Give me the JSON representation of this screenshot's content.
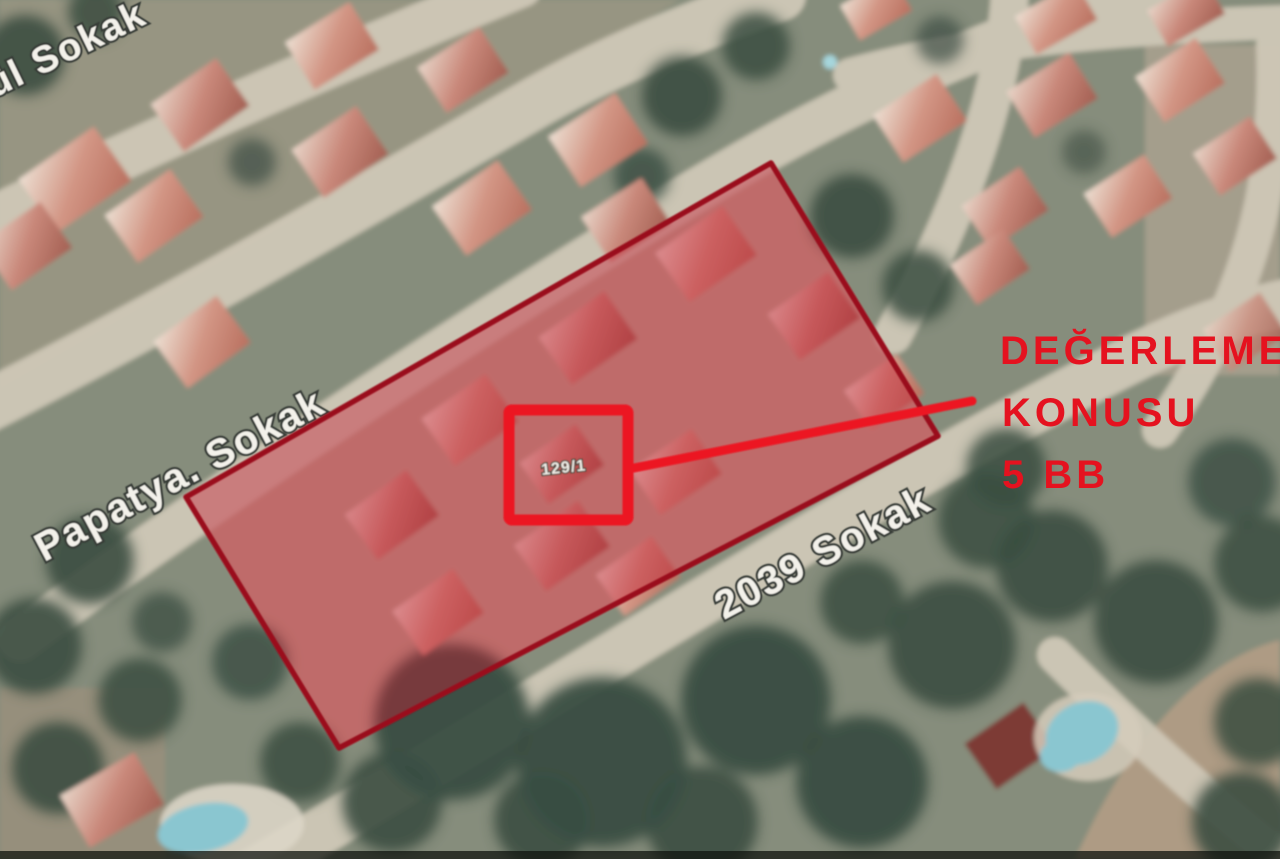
{
  "map": {
    "type": "satellite-aerial-view",
    "streets": [
      {
        "name": "ül Sokak"
      },
      {
        "name": "Papatya. Sokak"
      },
      {
        "name": "2039 Sokak"
      }
    ],
    "parcel_marker": {
      "label": "129/1"
    },
    "colors": {
      "highlight_fill": "#c31e30",
      "highlight_outline": "#9a0c1c",
      "marker_red": "#ec1220",
      "annotation_red": "#e5121f",
      "street_label_white": "#f3f1ea",
      "pool_blue": "#8ac6d0"
    }
  },
  "annotation": {
    "lines": [
      "DEĞERLEME",
      "KONUSU",
      "5 BB"
    ]
  }
}
